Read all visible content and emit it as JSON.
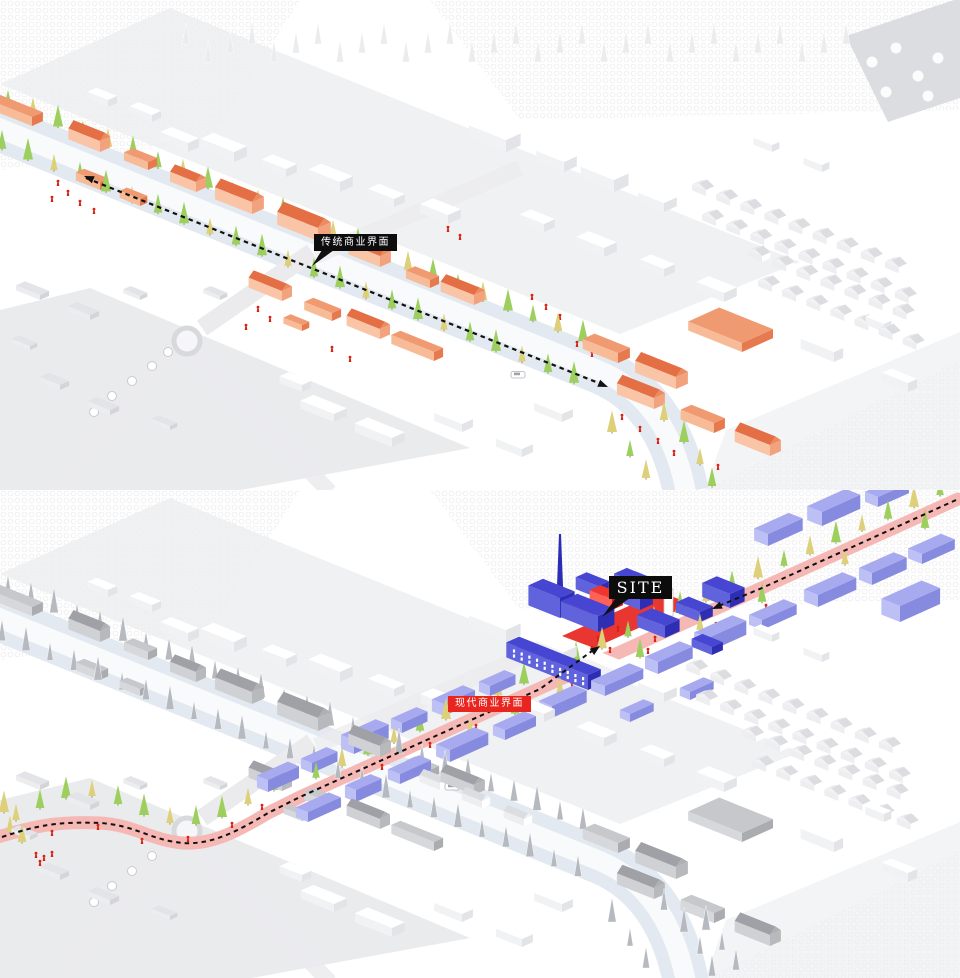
{
  "labels": {
    "traditional_callout": "传统商业界面",
    "site": "SITE",
    "modern_callout": "现代商业界面"
  },
  "palette": {
    "bg": "#ffffff",
    "ink": "#111111",
    "street": "#e3e9f0",
    "street_inner": "#f8fafc",
    "road_gray": "#ebebee",
    "road_edge": "#d8d9dc",
    "pink_road": "#f5b8b5",
    "orange_top": "#f09a72",
    "orange_se": "#e67a4e",
    "orange_sw": "#f8bb97",
    "o_wall_se": "#f3a27e",
    "o_wall_sw": "#f9c5a6",
    "o_roof_s": "#e46f45",
    "o_roof_n": "#f2977a",
    "o_gable": "#ec8a60",
    "purple_top": "#a7aaef",
    "purple_se": "#878bdf",
    "purple_sw": "#bdc0f4",
    "blue_top": "#4646d2",
    "blue_se": "#2e2eb4",
    "blue_sw": "#6063db",
    "red": "#e8251e",
    "red_top": "#f1352c",
    "red_se": "#c8150f",
    "red_sw": "#ff6157",
    "gray_top": "#c6c8cc",
    "gray_se": "#aaacb0",
    "gray_sw": "#d6d8db",
    "g_wall_se": "#b7b9bd",
    "g_wall_sw": "#cfd1d5",
    "g_roof_s": "#9fa1a6",
    "g_roof_n": "#c3c5c9",
    "g_gable": "#aeb0b4",
    "white_top": "#ffffff",
    "white_se": "#e3e4e7",
    "white_sw": "#f1f2f4",
    "h_roof": "#dcdde0",
    "tree_green": "#9ccf5d",
    "tree_yellow": "#ddd078",
    "tree_gray": "#b6bac0",
    "tree_pale": "#ebecee",
    "person": "#d62417",
    "parcel1": "#f0f1f3",
    "parcel2": "#eaebed",
    "parcel3": "#f3f4f6",
    "band_gray": "#dcdde0"
  }
}
